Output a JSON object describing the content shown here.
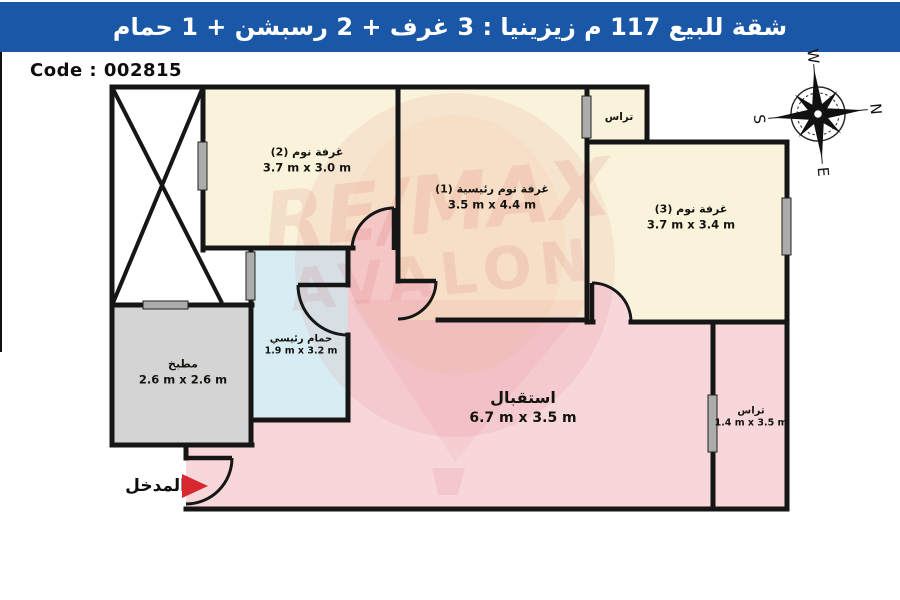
{
  "banner": {
    "title": "شقة للبيع 117 م زيزينيا :  3 غرف + 2 رسبشن + 1 حمام",
    "bg_color": "#1A57A6"
  },
  "code_label": "Code : 002815",
  "compass": {
    "n": "N",
    "s": "S",
    "e": "E",
    "w": "W"
  },
  "watermark": {
    "line1": "RE/MAX",
    "line2": "AVALON",
    "color": "#D7282F"
  },
  "entrance": {
    "label": "المدخل",
    "arrow_color": "#D7282F"
  },
  "rooms": {
    "bedroom2": {
      "name": "غرفة نوم (2)",
      "dims": "3.7 m x 3.0 m",
      "fill": "#FAF3DB"
    },
    "master": {
      "name": "غرفة نوم رئيسية (1)",
      "dims": "3.5 m x 4.4 m",
      "fill": "#FAF3DB"
    },
    "bedroom3": {
      "name": "غرفة نوم (3)",
      "dims": "3.7 m x 3.4 m",
      "fill": "#FAF3DB"
    },
    "bathroom": {
      "name": "حمام رئيسي",
      "dims": "1.9 m x 3.2 m",
      "fill": "#D8EDF3"
    },
    "kitchen": {
      "name": "مطبخ",
      "dims": "2.6 m x 2.6 m",
      "fill": "#D4D4D4"
    },
    "reception": {
      "name": "استقبال",
      "dims": "6.7 m x 3.5 m",
      "fill": "#F8D7DB"
    },
    "terrace_top": {
      "name": "تراس",
      "fill": "#FAF3DB"
    },
    "terrace_right": {
      "name": "تراس",
      "dims": "1.4 m x 3.5 m",
      "fill": "#F8D7DB"
    }
  }
}
